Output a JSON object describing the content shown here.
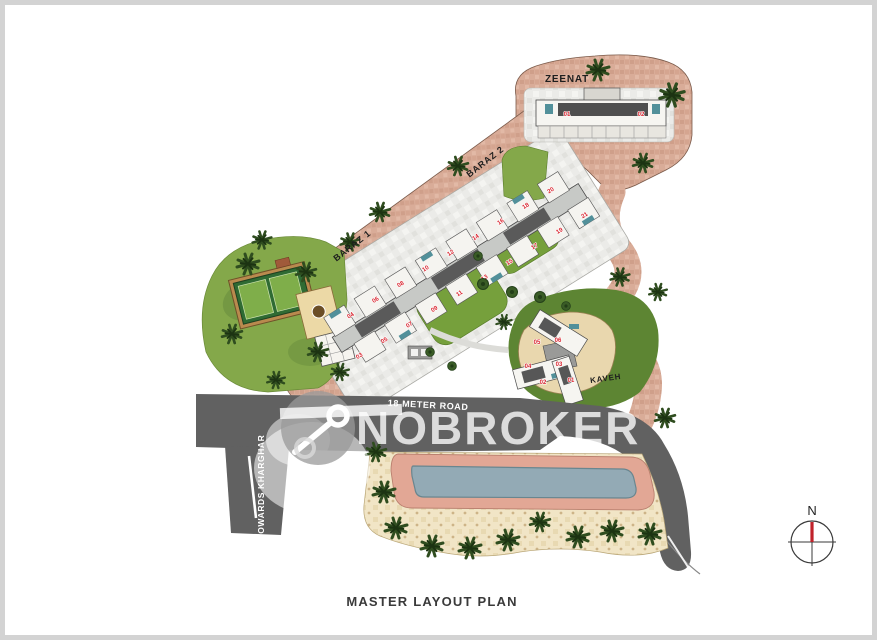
{
  "title": "MASTER LAYOUT PLAN",
  "watermark": {
    "brand": "NOBROKER"
  },
  "compass": {
    "north_label": "N"
  },
  "roads": {
    "main_road_label": "18 METER ROAD",
    "side_road_label": "TOWARDS KHARGHAR"
  },
  "buildings": {
    "zeenat": {
      "name": "ZEENAT",
      "units": [
        "01",
        "02"
      ]
    },
    "baraz1": {
      "name": "BARAZ 1"
    },
    "baraz2": {
      "name": "BARAZ 2"
    },
    "baraz_units": [
      "03",
      "04",
      "05",
      "06",
      "07",
      "08",
      "09",
      "10",
      "11",
      "12",
      "13",
      "14",
      "15",
      "16",
      "17",
      "18",
      "19",
      "20",
      "21"
    ],
    "kaveh": {
      "name": "KAVEH",
      "units": [
        "01",
        "02",
        "03",
        "04",
        "05",
        "06"
      ]
    }
  },
  "colors": {
    "terracotta": "#d9ac98",
    "road": "#616161",
    "green": "#84a84a",
    "dark_green": "#5d8533",
    "paving": "#ebebe8",
    "pool": "#93aab5",
    "pool_deck": "#e2a795",
    "beige": "#f1e5c6",
    "unit_red": "#d9232e"
  }
}
